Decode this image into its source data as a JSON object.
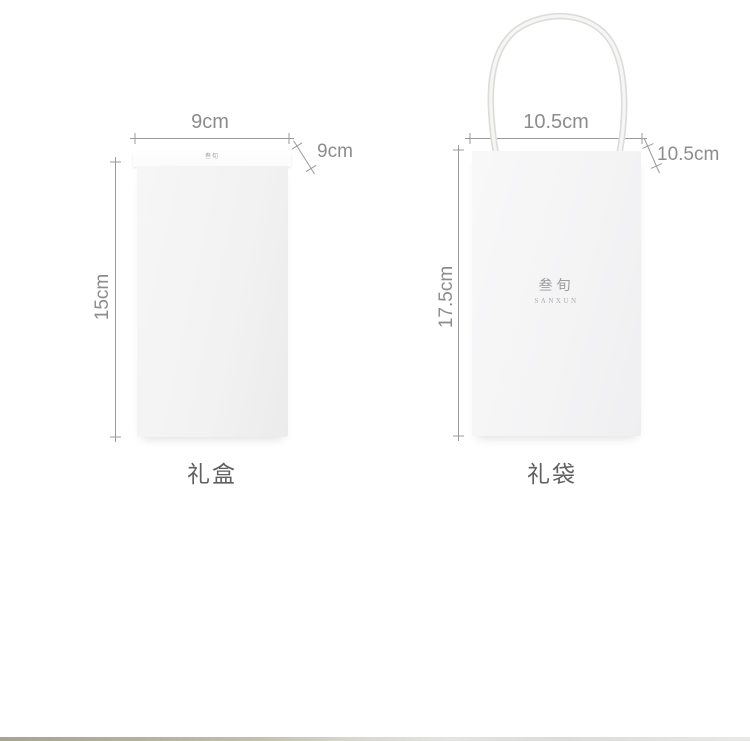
{
  "product_diagram": {
    "box": {
      "caption": "礼盒",
      "lid_logo": "叁旬",
      "width": "9cm",
      "depth": "9cm",
      "height": "15cm"
    },
    "bag": {
      "caption": "礼袋",
      "logo_cn": "叁旬",
      "logo_en": "SANXUN",
      "width": "10.5cm",
      "depth": "10.5cm",
      "height": "17.5cm"
    },
    "colors": {
      "background": "#ffffff",
      "box_fill": "#f2f2f3",
      "bag_fill": "#f5f5f6",
      "dimension_gray": "#8c8c8c",
      "caption_gray": "#606060",
      "handle_gray": "#dcdcda"
    }
  }
}
